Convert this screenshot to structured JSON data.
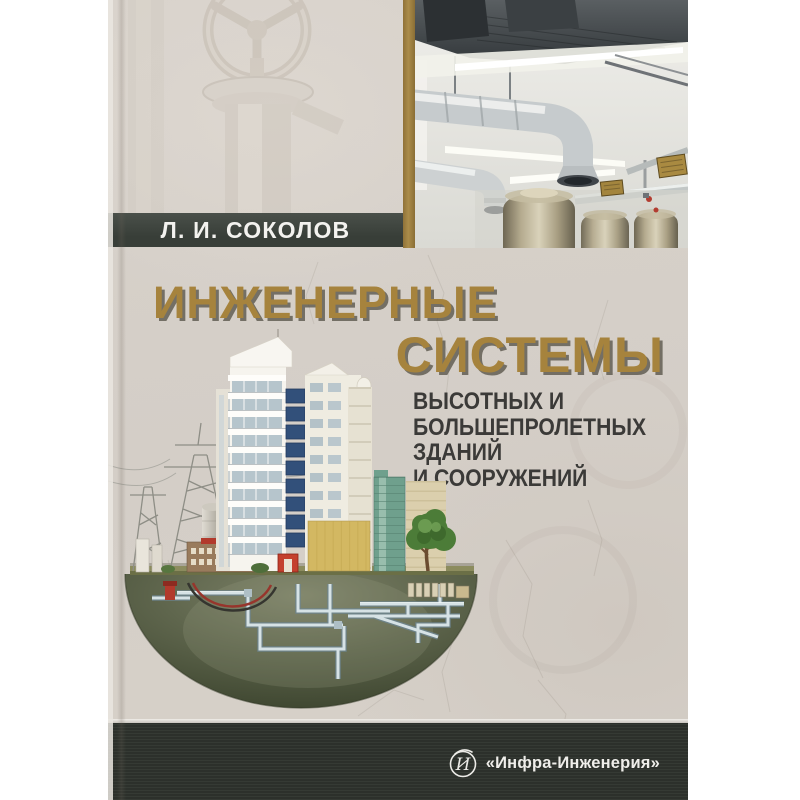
{
  "cover": {
    "author": "Л. И. СОКОЛОВ",
    "title_line1": "ИНЖЕНЕРНЫЕ",
    "title_line2": "СИСТЕМЫ",
    "subtitle_lines": [
      "ВЫСОТНЫХ И",
      "БОЛЬШЕПРОЛЕТНЫХ",
      "ЗДАНИЙ",
      "И СООРУЖЕНИЙ"
    ],
    "publisher_logo_letter": "И",
    "publisher_name": "«Инфра-Инженерия»"
  },
  "colors": {
    "cover-bg": "#d5cfc8",
    "title-gold": "#a6833d",
    "stripe-gold": "#ab8c4a",
    "author-bar": "#383e38",
    "subtitle-ink": "#3b3a38",
    "footer-bar": "#2e332d",
    "publisher-ink": "#efeeea",
    "hemisphere-green": "#555e45"
  }
}
